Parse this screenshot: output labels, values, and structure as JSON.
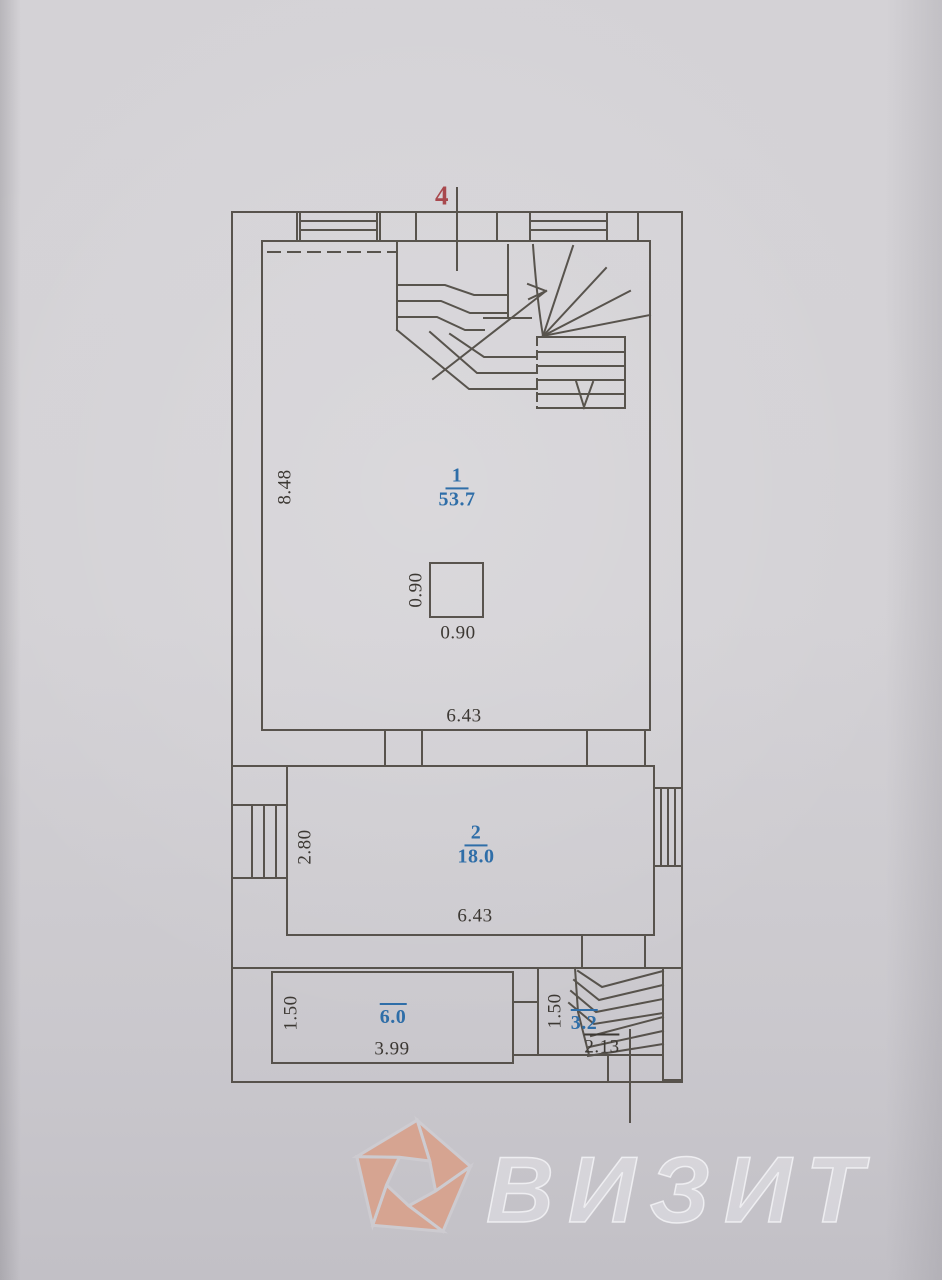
{
  "plan": {
    "section_marker": "4",
    "rooms": [
      {
        "number": "1",
        "area": "53.7"
      },
      {
        "number": "2",
        "area": "18.0"
      },
      {
        "area": "6.0"
      },
      {
        "area": "3.2"
      }
    ],
    "dimensions": {
      "room1_height": "8.48",
      "room1_width": "6.43",
      "column_width": "0.90",
      "column_height": "0.90",
      "room2_height": "2.80",
      "room2_width": "6.43",
      "room3_height": "1.50",
      "room3_width": "3.99",
      "room4_height": "1.50",
      "room4_width": "2.13"
    }
  },
  "watermark": {
    "text": "ВИЗИТ",
    "logo": "aperture-pentagon-icon",
    "logo_color": "#d9a08a",
    "text_color": "#eceaef"
  },
  "colors": {
    "paper": "#cfcdd2",
    "line": "#4e4942",
    "room_label_blue": "#2f6ea8",
    "section_marker_red": "#a8484d"
  }
}
